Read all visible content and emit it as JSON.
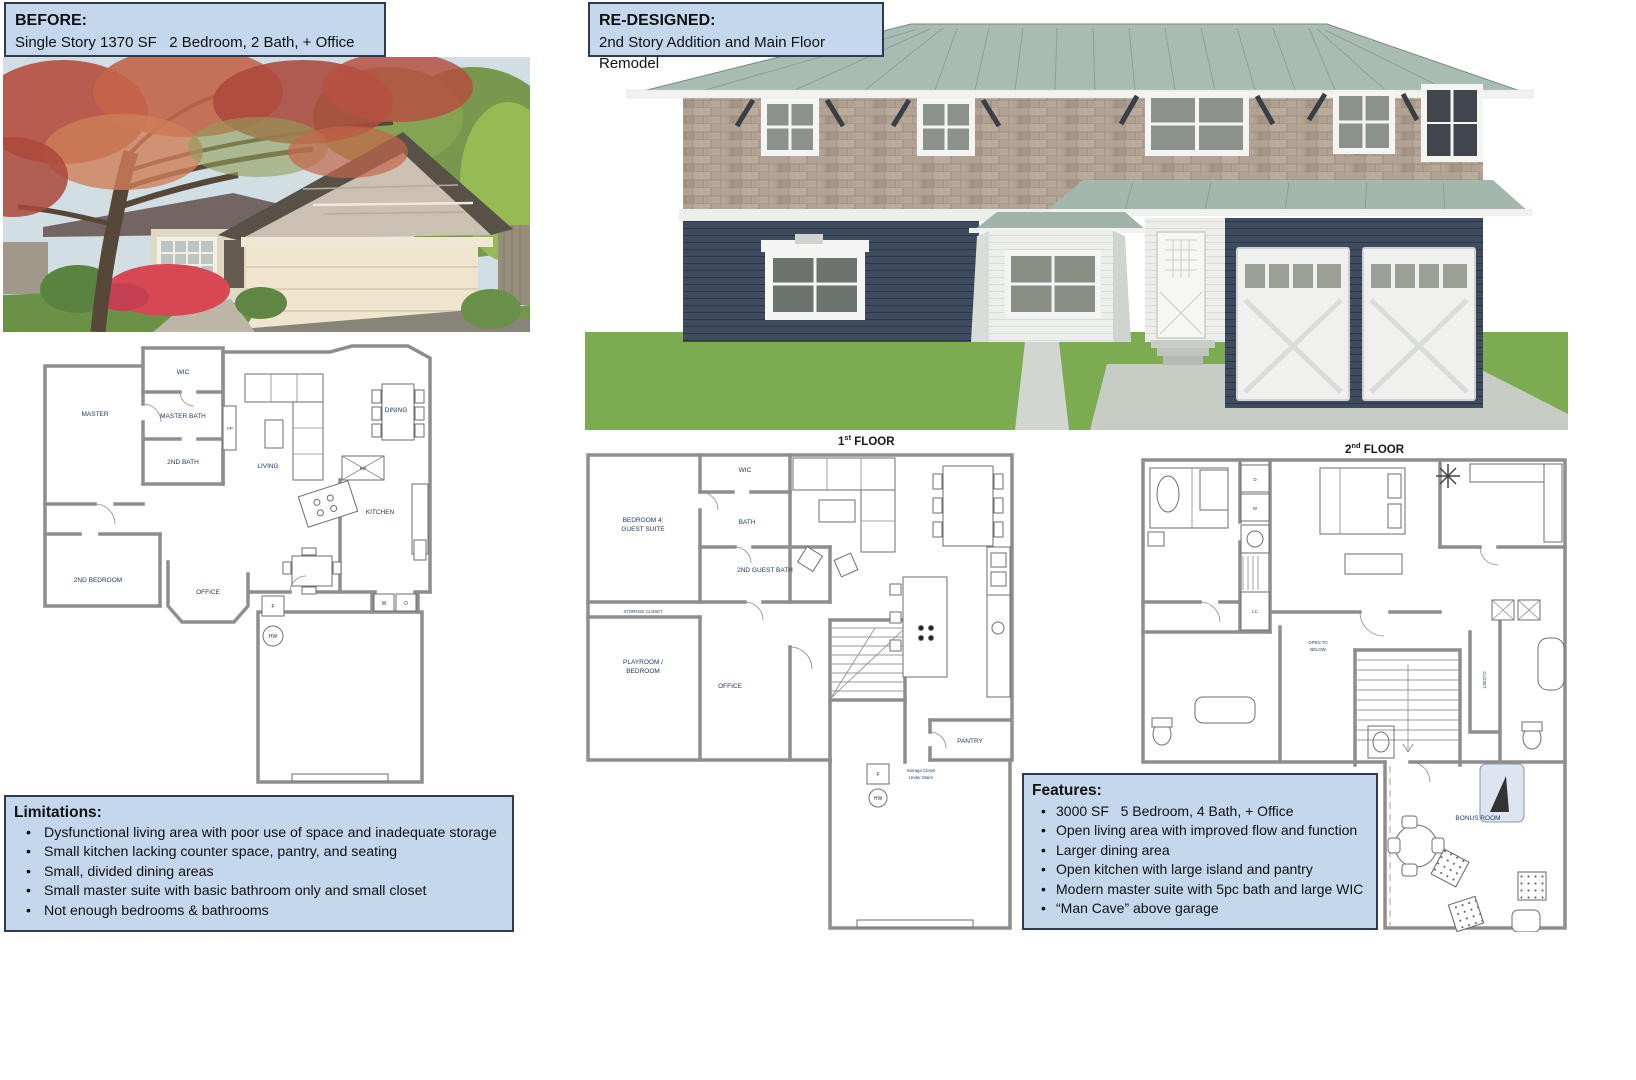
{
  "colors": {
    "callout_bg": "#c5d7ec",
    "callout_border": "#2e3b4e",
    "siding_navy": "#3f4b5e",
    "roof_green": "#a9bcb2",
    "shingle_tan": "#b1a294",
    "grass_green": "#7cab51",
    "plan_label": "#1f3864"
  },
  "callouts": {
    "before": {
      "title": "BEFORE:",
      "subtitle": "Single Story 1370 SF   2 Bedroom, 2 Bath, + Office"
    },
    "redesigned": {
      "title": "RE-DESIGNED:",
      "subtitle": "2nd Story Addition and Main Floor Remodel"
    }
  },
  "limitations": {
    "title": "Limitations:",
    "items": [
      "Dysfunctional living area with poor use of space and inadequate storage",
      "Small kitchen lacking counter space, pantry, and seating",
      "Small, divided dining areas",
      "Small master suite with basic bathroom only and small closet",
      "Not enough bedrooms & bathrooms"
    ]
  },
  "features": {
    "title": "Features:",
    "items": [
      "3000 SF   5 Bedroom, 4 Bath, + Office",
      "Open living area with improved flow and function",
      "Larger dining area",
      "Open kitchen with large island and pantry",
      "Modern master suite with 5pc bath and large WIC",
      "“Man Cave” above garage"
    ]
  },
  "plans": {
    "before": {
      "rooms": {
        "wic": "WIC",
        "master": "MASTER",
        "master_bath": "MASTER BATH",
        "second_bath": "2ND BATH",
        "second_bedroom": "2ND BEDROOM",
        "office": "OFFICE",
        "living": "LIVING",
        "dining": "DINING",
        "kitchen": "KITCHEN"
      },
      "fixtures": {
        "fireplace": "FP",
        "fridge": "Ref",
        "freezer": "F",
        "water_heater": "HW",
        "washer": "W",
        "dryer": "D"
      }
    },
    "first": {
      "title": {
        "num": "1",
        "sup": "st",
        "rest": " FLOOR"
      },
      "rooms": {
        "bedroom4_l1": "BEDROOM 4:",
        "bedroom4_l2": "GUEST SUITE",
        "wic": "WIC",
        "bath": "BATH",
        "guest_bath": "2ND GUEST BATH",
        "storage": "STORAGE CLOSET",
        "playroom_l1": "PLAYROOM /",
        "playroom_l2": "BEDROOM",
        "office": "OFFICE",
        "pantry": "PANTRY",
        "under_stairs_l1": "Storage Closet",
        "under_stairs_l2": "Under Stairs"
      },
      "fixtures": {
        "freezer": "F",
        "water_heater": "HW"
      }
    },
    "second": {
      "title": {
        "num": "2",
        "sup": "nd",
        "rest": " FLOOR"
      },
      "rooms": {
        "open_l1": "OPEN TO",
        "open_l2": "BELOW",
        "closet": "CLOSET",
        "bonus": "BONUS ROOM",
        "lc": "LC",
        "dryer": "D",
        "washer": "W"
      }
    }
  }
}
